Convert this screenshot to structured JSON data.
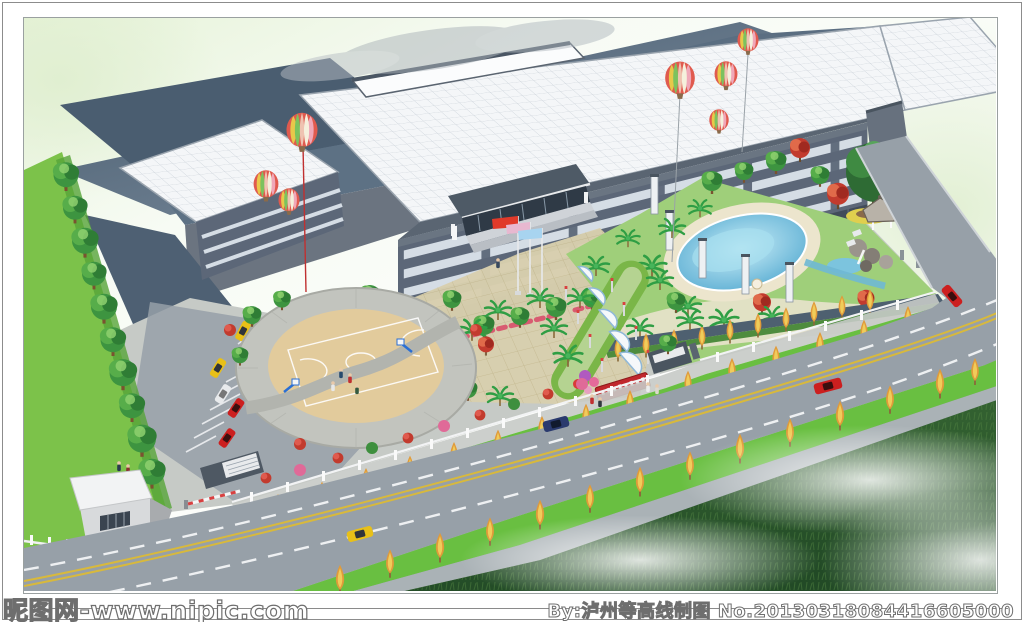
{
  "watermark": {
    "left": "昵图网-www.nipic.com",
    "right": "By:泸州等高线制图 No.20130318084416605000"
  },
  "palette": {
    "roof_white": "#f4f6f8",
    "roof_slate": "#46586c",
    "facade_dark": "#5c6778",
    "facade_light": "#d5dde5",
    "paving": "#c6cac6",
    "plaza_tan": "#d8cfae",
    "asphalt": "#97a0a8",
    "lane_white": "#f2f4f6",
    "lane_yellow": "#d8b93c",
    "grass_bright": "#7cc24a",
    "grass_verge": "#69bf41",
    "grass_wild": "#2f5b33",
    "tree_green": "#3d9440",
    "palm_green": "#2f9e44",
    "tree_yellow": "#e09a3a",
    "maple_red": "#c23b2e",
    "flower_pink": "#e56a9a",
    "pool_blue": "#8ed4ea",
    "flag_red": "#e03a2a",
    "flag_blue": "#a8d4f0",
    "flag_pink": "#e8b8d0",
    "car_yellow": "#e8c018",
    "car_red": "#cc1f1f",
    "car_blue": "#2a3a6e",
    "balloon_red": "#e05a4e",
    "balloon_green": "#7cc25e",
    "balloon_yellow": "#e8c84a",
    "balloon_pink": "#f0a8b8",
    "balloon_cream": "#f5f0dc",
    "sky_green": "#e8f4dc",
    "frame_border": "#8c8c8c"
  }
}
